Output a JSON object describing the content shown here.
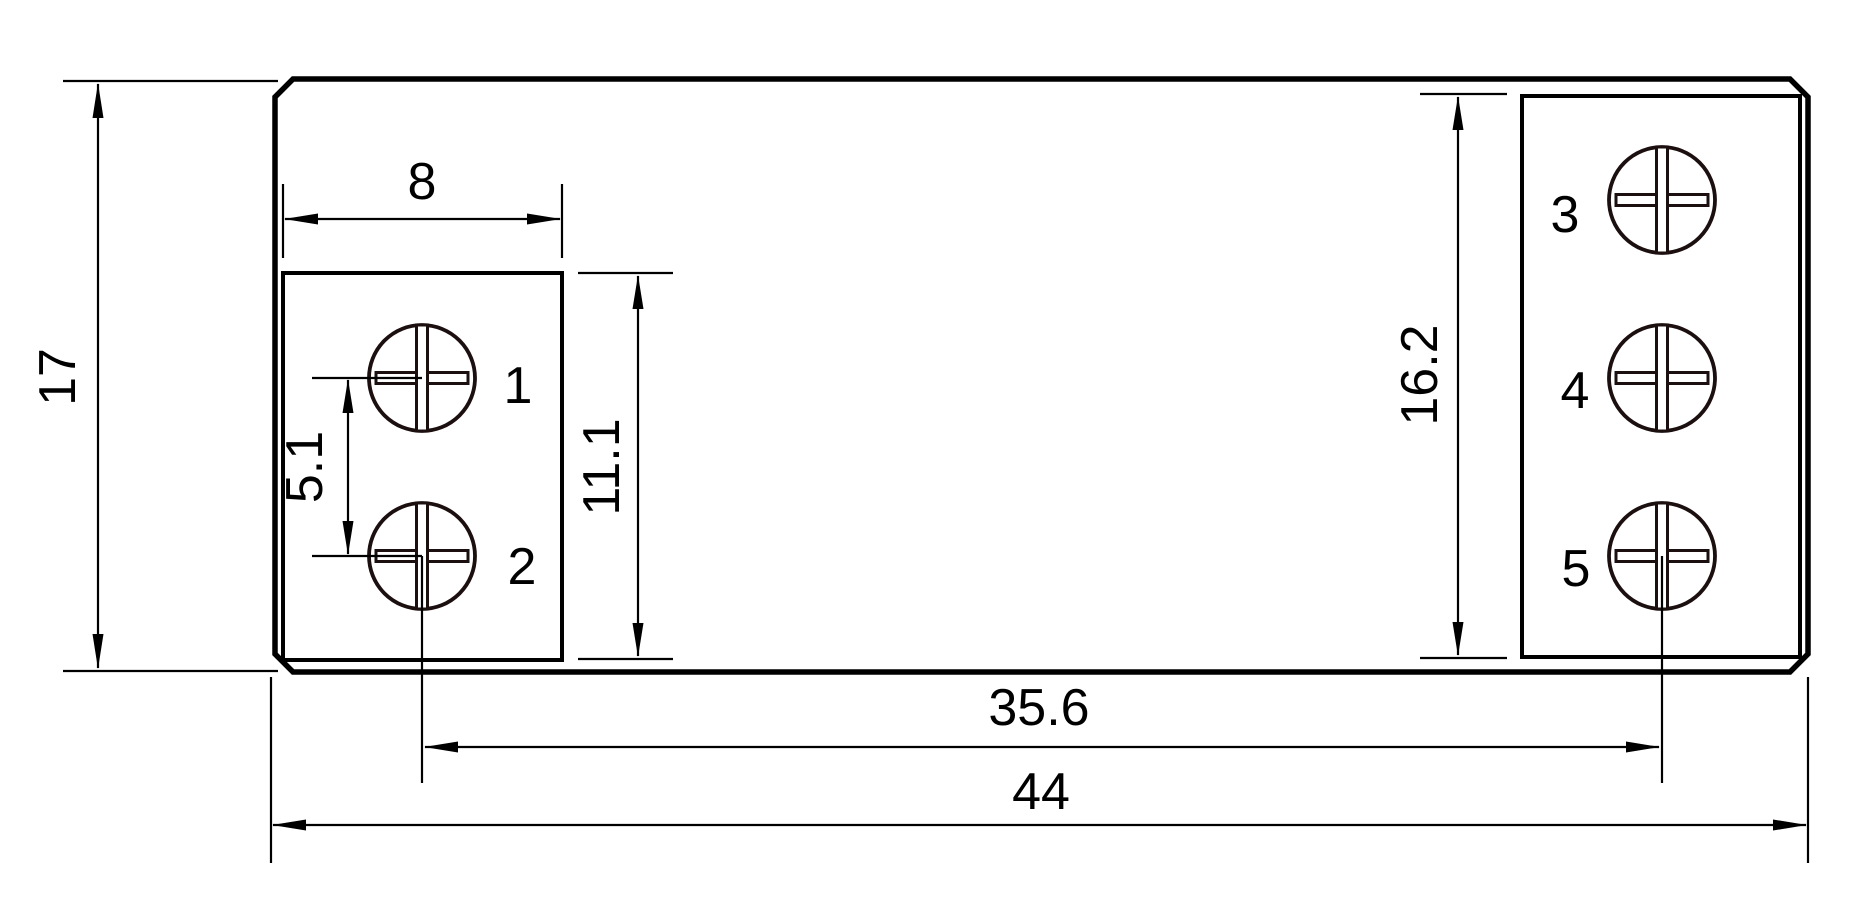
{
  "colors": {
    "background": "#ffffff",
    "line": "#000000",
    "screw_line": "#1c0f0f",
    "label_red": "#ed2024"
  },
  "dimensions": {
    "overall_height": "17",
    "overall_width": "44",
    "block_width": "8",
    "screw_pitch": "5.1",
    "left_block_height": "11.1",
    "right_block_height": "16.2",
    "screw_span": "35.6"
  },
  "terminals": {
    "t1": "1",
    "t2": "2",
    "t3": "3",
    "t4": "4",
    "t5": "5"
  }
}
